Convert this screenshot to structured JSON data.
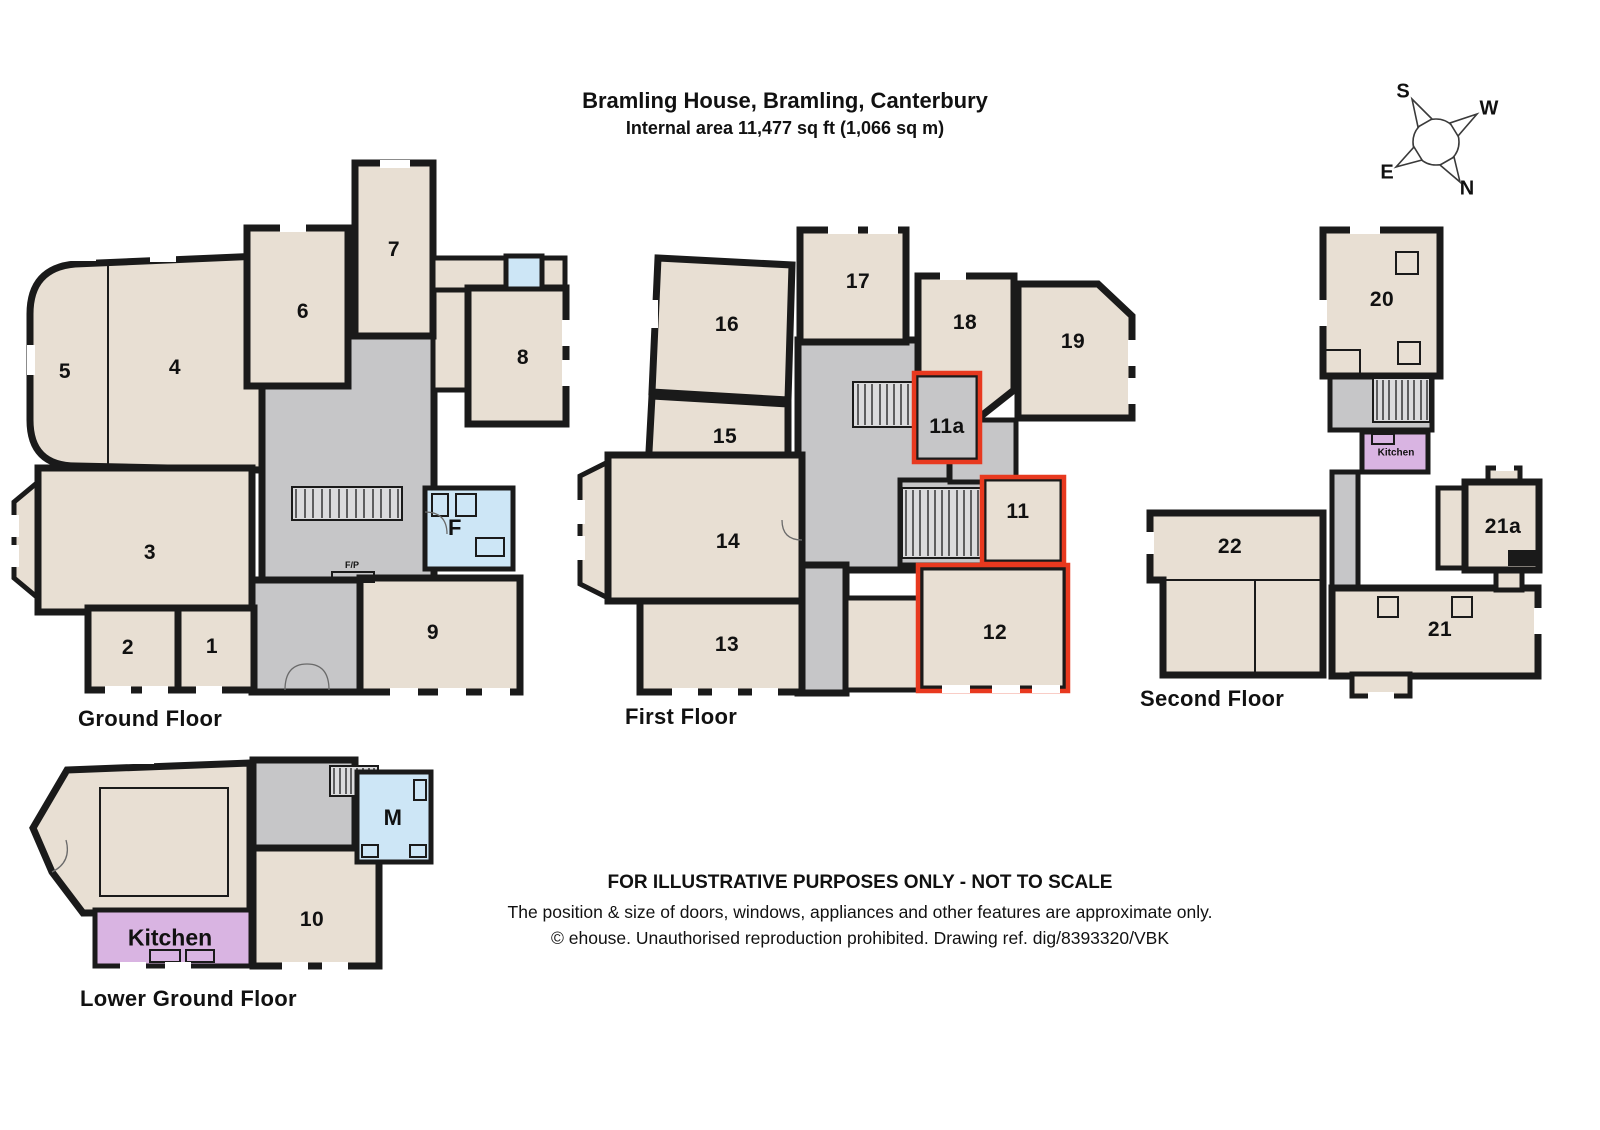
{
  "title": {
    "line1": "Bramling House, Bramling, Canterbury",
    "line2": "Internal area 11,477 sq ft (1,066 sq m)"
  },
  "compass": {
    "n": "N",
    "s": "S",
    "e": "E",
    "w": "W"
  },
  "floors": {
    "ground": {
      "label": "Ground Floor",
      "rooms": {
        "r1": "1",
        "r2": "2",
        "r3": "3",
        "r4": "4",
        "r5": "5",
        "r6": "6",
        "r7": "7",
        "r8": "8",
        "r9": "9",
        "f": "F",
        "fp": "F/P"
      }
    },
    "first": {
      "label": "First Floor",
      "rooms": {
        "r11": "11",
        "r11a": "11a",
        "r12": "12",
        "r13": "13",
        "r14": "14",
        "r15": "15",
        "r16": "16",
        "r17": "17",
        "r18": "18",
        "r19": "19"
      }
    },
    "second": {
      "label": "Second Floor",
      "rooms": {
        "r20": "20",
        "r21": "21",
        "r21a": "21a",
        "r22": "22",
        "kitchen": "Kitchen"
      }
    },
    "lower": {
      "label": "Lower Ground Floor",
      "rooms": {
        "r10": "10",
        "kitchen": "Kitchen",
        "m": "M"
      }
    }
  },
  "footer": {
    "line1": "FOR ILLUSTRATIVE PURPOSES ONLY - NOT TO SCALE",
    "line2": "The position & size of doors, windows, appliances and other features are approximate only.",
    "line3": "© ehouse. Unauthorised reproduction prohibited. Drawing ref. dig/8393320/VBK"
  },
  "colors": {
    "wall": "#1a1a1a",
    "room": "#e8dfd3",
    "hall": "#c6c6c8",
    "wet": "#cde6f6",
    "kitchen": "#d9b4e2",
    "highlight": "#e8391f"
  }
}
